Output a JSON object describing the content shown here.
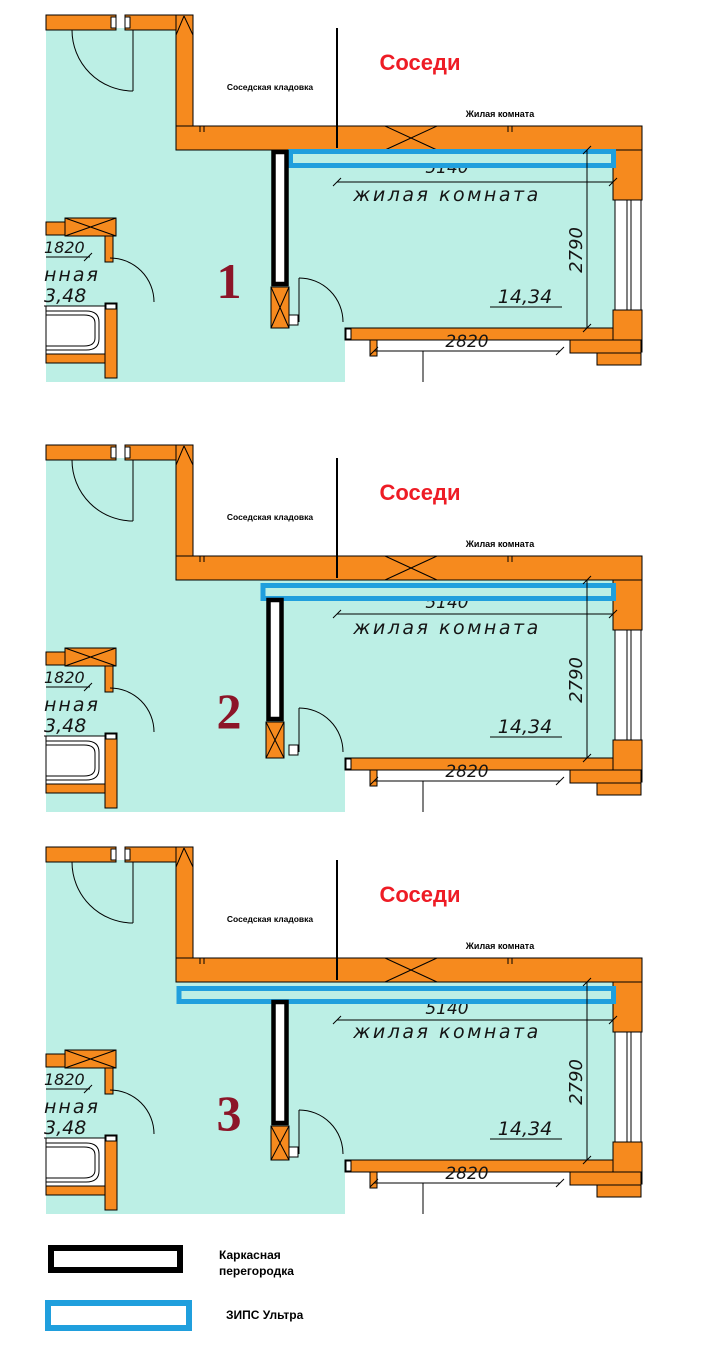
{
  "plans": [
    {
      "number": "1",
      "neighbors_label": "Соседи",
      "storage_label": "Соседская кладовка",
      "neighbor_room_label": "Жилая комната",
      "room_label": "жилая  комната",
      "room_area": "14,34",
      "bath_label": "нная",
      "bath_area": "3,48",
      "dims": {
        "top": "5140",
        "right": "2790",
        "bottom": "2820",
        "left": "1820"
      }
    },
    {
      "number": "2",
      "neighbors_label": "Соседи",
      "storage_label": "Соседская кладовка",
      "neighbor_room_label": "Жилая комната",
      "room_label": "жилая  комната",
      "room_area": "14,34",
      "bath_label": "нная",
      "bath_area": "3,48",
      "dims": {
        "top": "5140",
        "right": "2790",
        "bottom": "2820",
        "left": "1820"
      }
    },
    {
      "number": "3",
      "neighbors_label": "Соседи",
      "storage_label": "Соседская кладовка",
      "neighbor_room_label": "Жилая комната",
      "room_label": "жилая  комната",
      "room_area": "14,34",
      "bath_label": "нная",
      "bath_area": "3,48",
      "dims": {
        "top": "5140",
        "right": "2790",
        "bottom": "2820",
        "left": "1820"
      }
    }
  ],
  "legend": {
    "frame_partition": {
      "line1": "Каркасная",
      "line2": "перегородка"
    },
    "zips_ultra": {
      "label": "ЗИПС Ультра"
    }
  },
  "colors": {
    "wall_orange": "#F68A1E",
    "room_teal": "#BCEFE5",
    "zips_blue": "#209FDD",
    "neighbors_red": "#EE1C25",
    "variant_number_maroon": "#8C1528"
  }
}
